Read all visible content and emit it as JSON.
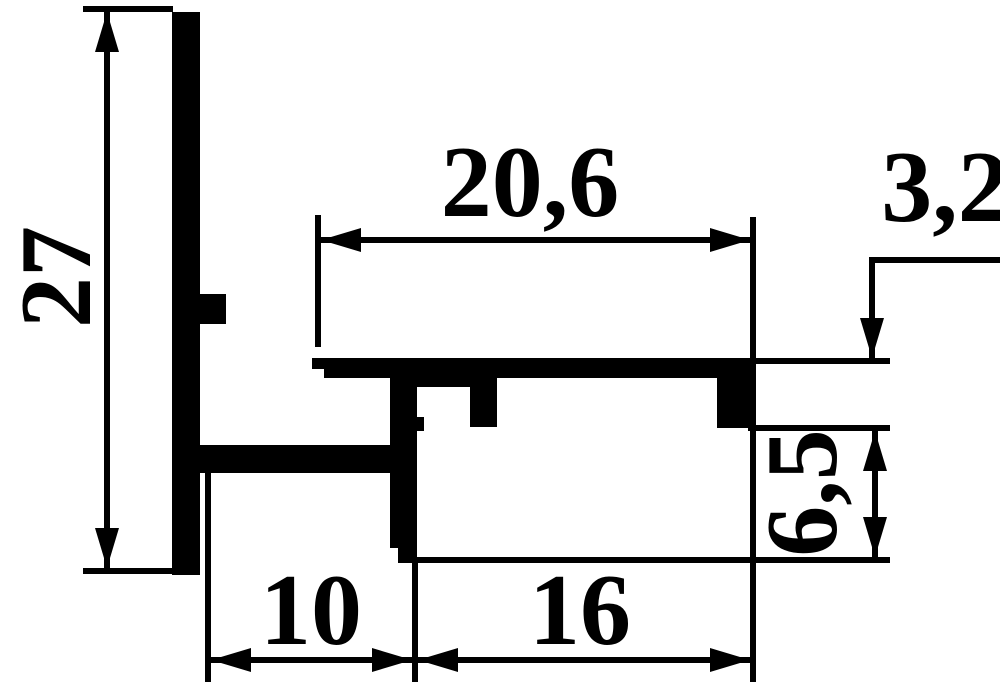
{
  "drawing": {
    "description": "Aluminium profile cross-section technical drawing",
    "colors": {
      "ink": "#000000",
      "paper": "#ffffff"
    },
    "dimensions": {
      "overall_height": "27",
      "top_flange_width": "20,6",
      "flange_lip_depth": "3,2",
      "channel_depth": "6,5",
      "bottom_left_span": "10",
      "bottom_right_span": "16"
    }
  }
}
